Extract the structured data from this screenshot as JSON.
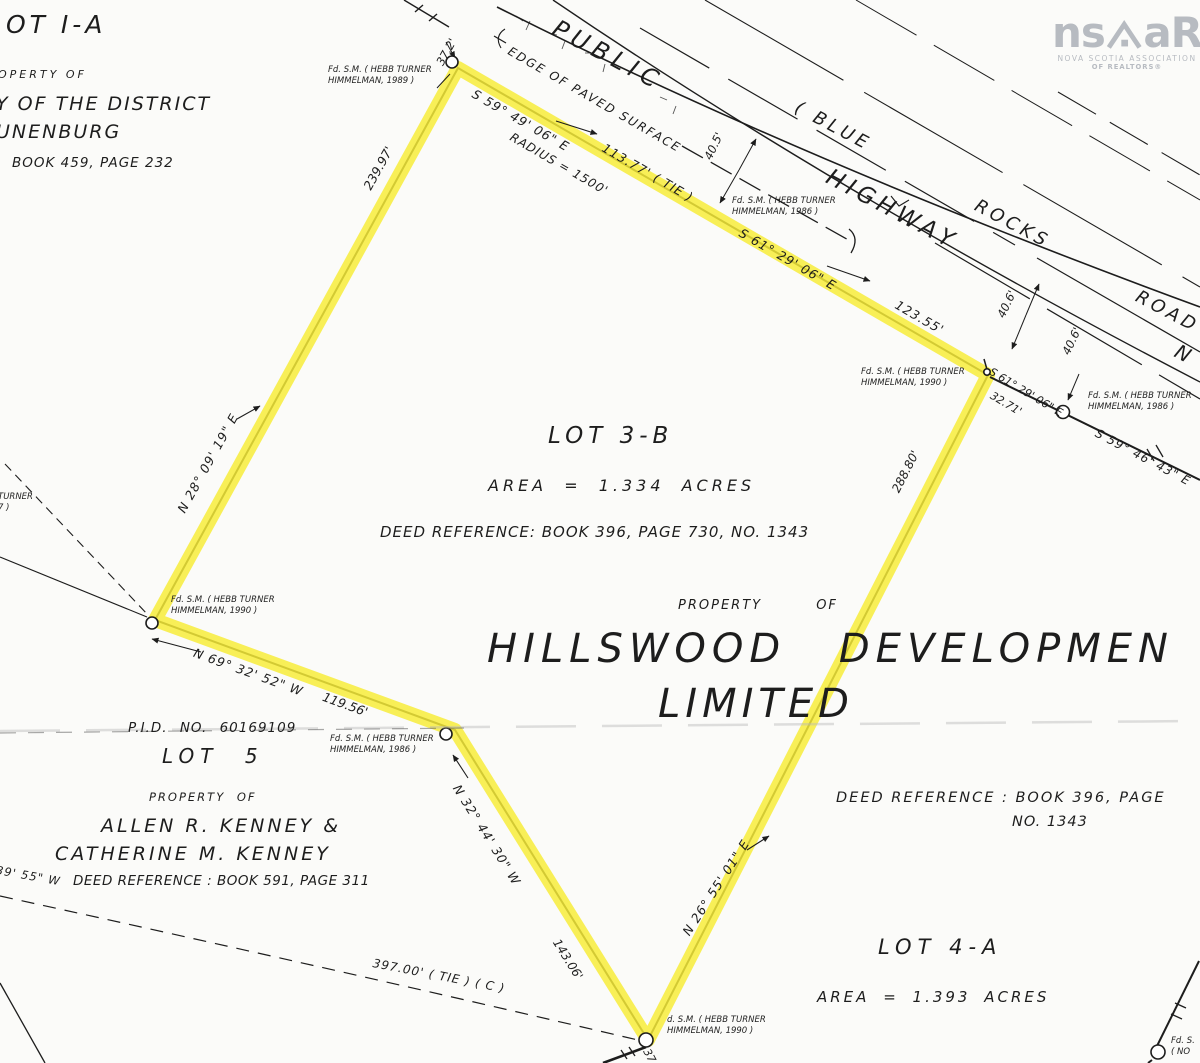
{
  "colors": {
    "highlight_yellow": "#f7ec33",
    "ink_black": "#1d1d1d",
    "logo_gray": "#b7bbc1"
  },
  "logo": {
    "name_left": "ns",
    "name_right": "aR",
    "tagline_line1": "NOVA SCOTIA ASSOCIATION",
    "tagline_line2": "OF REALTORS®"
  },
  "road": {
    "label_public": "PUBLIC",
    "label_highway": "HIGHWAY",
    "label_blue": "( BLUE",
    "label_rocks": "ROCKS",
    "label_road": "ROAD",
    "label_n": "N",
    "edge_of_paved_surface": "EDGE OF PAVED SURFACE"
  },
  "parcel_upper_left": {
    "lot_title": "OT I-A",
    "property_of": "OPERTY OF",
    "owner_line1": "Y OF THE DISTRICT",
    "owner_line2": "UNENBURG",
    "deed_reference": "BOOK 459, PAGE 232"
  },
  "lot_3b": {
    "lot_title": "LOT 3-B",
    "area": "AREA = 1.334 ACRES",
    "deed_reference": "DEED REFERENCE: BOOK 396, PAGE 730, NO. 1343",
    "property_of": "PROPERTY OF",
    "owner_line1": "HILLSWOOD DEVELOPMEN",
    "owner_line2": "LIMITED"
  },
  "lot_5": {
    "pid": "P.I.D. NO. 60169109",
    "lot_title": "LOT 5",
    "property_of": "PROPERTY OF",
    "owner_line1": "ALLEN R. KENNEY &",
    "owner_line2": "CATHERINE M. KENNEY",
    "deed_reference": "DEED REFERENCE : BOOK 591, PAGE 311"
  },
  "lot_4a": {
    "deed_reference_line1": "DEED REFERENCE : BOOK 396, PAGE",
    "deed_reference_line2": "NO. 1343",
    "lot_title": "LOT 4-A",
    "area": "AREA = 1.393 ACRES"
  },
  "bearings": [
    "S 59° 49' 06\" E",
    "113.77' ( TIE )",
    "RADIUS = 1500'",
    "S 61° 29' 06\" E",
    "123.55'",
    "40.5'",
    "40.6'",
    "40.6'",
    "S 61° 29' 06\" E",
    "32.71'",
    "S 59° 46' 43\" E",
    "288.80'",
    "N 28° 09' 19\" E",
    "239.97'",
    "37.2'",
    "N 69° 32' 52\" W",
    "119.56'",
    "N 32° 44' 30\" W",
    "143.06'",
    "N 26° 55' 01\" E",
    "397.00' ( TIE ) ( C )",
    "39' 55\" W",
    "37"
  ],
  "monuments": [
    {
      "l1": "Fd. S.M. ( HEBB TURNER",
      "l2": "HIMMELMAN, 1989 )"
    },
    {
      "l1": "Fd. S.M. ( HEBB TURNER",
      "l2": "HIMMELMAN, 1986 )"
    },
    {
      "l1": "Fd. S.M. ( HEBB TURNER",
      "l2": "HIMMELMAN, 1990 )"
    },
    {
      "l1": "Fd. S.M. ( HEBB TURNER",
      "l2": "HIMMELMAN, 1986 )"
    },
    {
      "l1": "Fd. S.M. ( HEBB TURNER",
      "l2": "HIMMELMAN, 1990 )"
    },
    {
      "l1": "Fd. S.M. ( HEBB TURNER",
      "l2": "HIMMELMAN, 1986 )"
    },
    {
      "l1": "d. S.M. ( HEBB TURNER",
      "l2": "HIMMELMAN, 1990 )"
    },
    {
      "l1": "Fd. S.",
      "l2": "( NO"
    },
    {
      "l1": "TURNER",
      "l2": "7 )"
    }
  ]
}
